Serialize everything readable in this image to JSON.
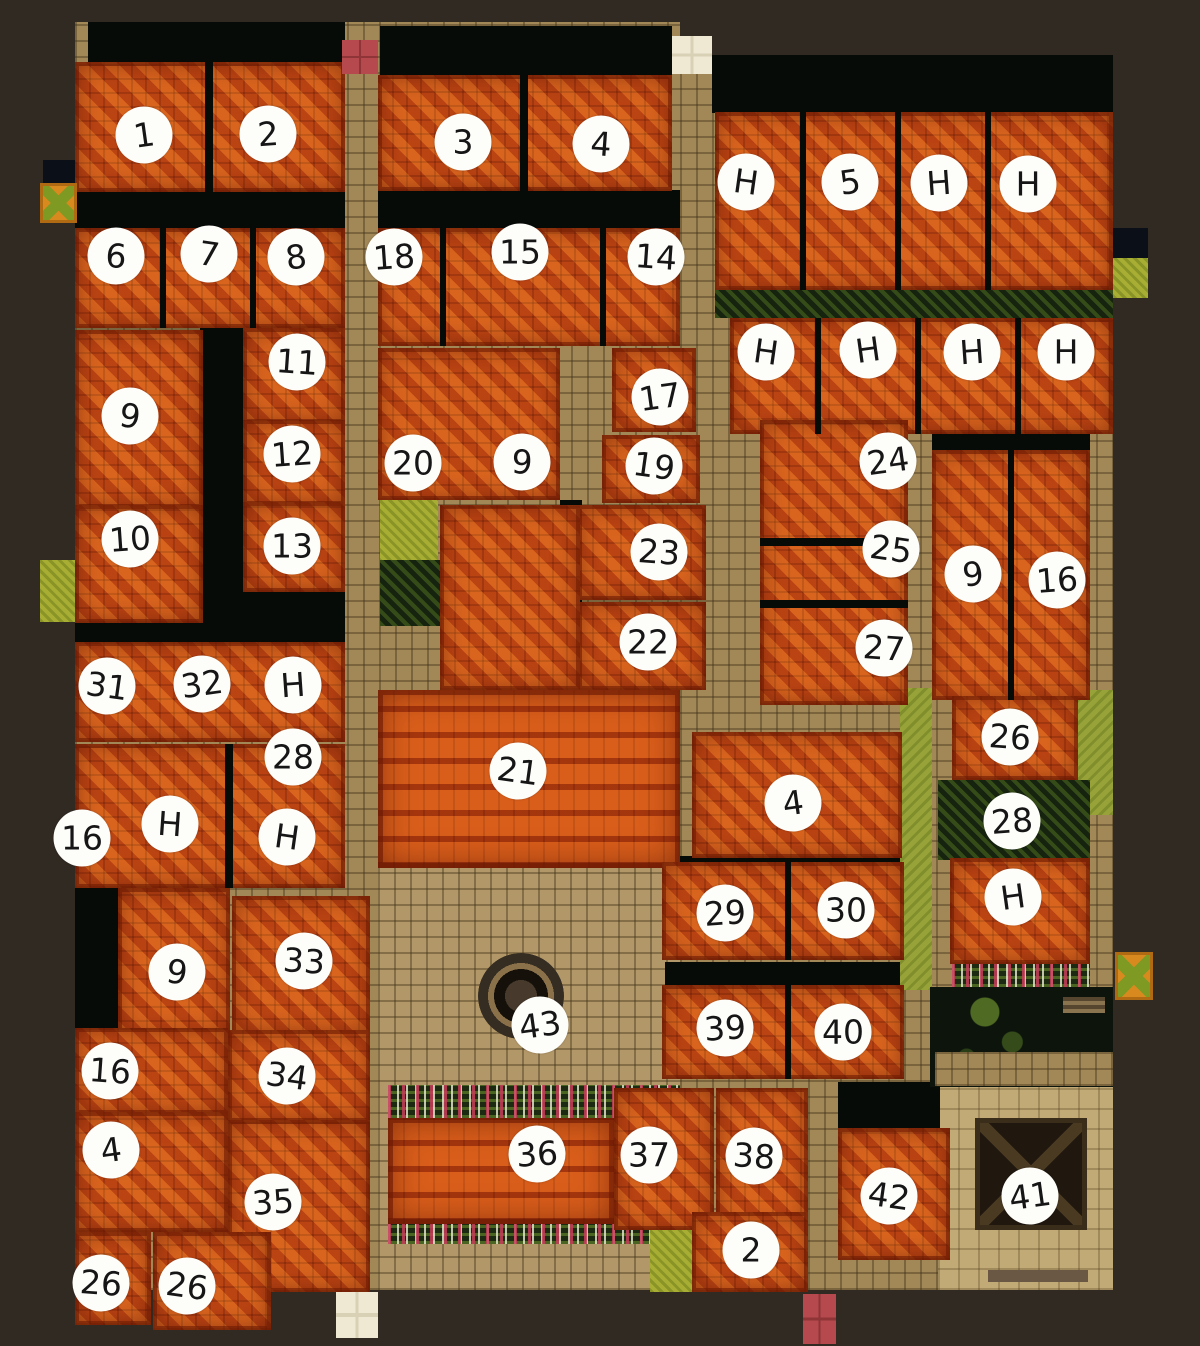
{
  "scene": {
    "description": "Top-down fantasy town battle map with orange tiled rooftops, stone streets, gardens and a central plaza with a well; buildings annotated with hand-drawn numbered circles",
    "marker_shape": "white circle",
    "marker_diameter_px": 57
  },
  "palette": {
    "background": "#312a22",
    "roof": "#c94e17",
    "roof_light": "#e8822c",
    "roof_dark": "#7a2408",
    "street": "#a28757",
    "plaza": "#b29768",
    "courtyard": "#c2aa76",
    "shadow": "#070b08",
    "hedge": "#16240f",
    "grass": "#a8ae33",
    "lawn": "#97a238",
    "dark_garden": "#0c140c",
    "marker_fill": "#fdfdfa",
    "marker_text": "#161616",
    "accent_red": "#b5494d",
    "accent_white": "#efe8d2"
  },
  "map": {
    "markers": [
      {
        "label": "1",
        "x": 144,
        "y": 135
      },
      {
        "label": "2",
        "x": 268,
        "y": 134
      },
      {
        "label": "3",
        "x": 463,
        "y": 142
      },
      {
        "label": "4",
        "x": 601,
        "y": 144
      },
      {
        "label": "H",
        "x": 746,
        "y": 182
      },
      {
        "label": "5",
        "x": 850,
        "y": 182
      },
      {
        "label": "H",
        "x": 939,
        "y": 183
      },
      {
        "label": "H",
        "x": 1028,
        "y": 184
      },
      {
        "label": "6",
        "x": 116,
        "y": 256
      },
      {
        "label": "7",
        "x": 209,
        "y": 254
      },
      {
        "label": "8",
        "x": 296,
        "y": 257
      },
      {
        "label": "18",
        "x": 394,
        "y": 257
      },
      {
        "label": "15",
        "x": 520,
        "y": 252
      },
      {
        "label": "14",
        "x": 656,
        "y": 257
      },
      {
        "label": "H",
        "x": 766,
        "y": 352
      },
      {
        "label": "H",
        "x": 868,
        "y": 350
      },
      {
        "label": "H",
        "x": 972,
        "y": 352
      },
      {
        "label": "H",
        "x": 1066,
        "y": 352
      },
      {
        "label": "11",
        "x": 297,
        "y": 362
      },
      {
        "label": "9",
        "x": 130,
        "y": 416
      },
      {
        "label": "17",
        "x": 660,
        "y": 397
      },
      {
        "label": "12",
        "x": 292,
        "y": 454
      },
      {
        "label": "20",
        "x": 413,
        "y": 463
      },
      {
        "label": "9",
        "x": 522,
        "y": 462
      },
      {
        "label": "19",
        "x": 654,
        "y": 466
      },
      {
        "label": "24",
        "x": 888,
        "y": 461
      },
      {
        "label": "10",
        "x": 130,
        "y": 539
      },
      {
        "label": "13",
        "x": 292,
        "y": 546
      },
      {
        "label": "23",
        "x": 659,
        "y": 552
      },
      {
        "label": "25",
        "x": 891,
        "y": 549
      },
      {
        "label": "9",
        "x": 973,
        "y": 574
      },
      {
        "label": "16",
        "x": 1057,
        "y": 580
      },
      {
        "label": "22",
        "x": 648,
        "y": 642
      },
      {
        "label": "27",
        "x": 884,
        "y": 648
      },
      {
        "label": "31",
        "x": 107,
        "y": 686
      },
      {
        "label": "32",
        "x": 202,
        "y": 684
      },
      {
        "label": "H",
        "x": 293,
        "y": 685
      },
      {
        "label": "28",
        "x": 293,
        "y": 757
      },
      {
        "label": "26",
        "x": 1010,
        "y": 737
      },
      {
        "label": "21",
        "x": 518,
        "y": 771
      },
      {
        "label": "4",
        "x": 793,
        "y": 803
      },
      {
        "label": "28",
        "x": 1012,
        "y": 821
      },
      {
        "label": "16",
        "x": 82,
        "y": 838
      },
      {
        "label": "H",
        "x": 170,
        "y": 824
      },
      {
        "label": "H",
        "x": 287,
        "y": 837
      },
      {
        "label": "H",
        "x": 1013,
        "y": 897
      },
      {
        "label": "29",
        "x": 725,
        "y": 913
      },
      {
        "label": "30",
        "x": 846,
        "y": 910
      },
      {
        "label": "33",
        "x": 304,
        "y": 961
      },
      {
        "label": "9",
        "x": 177,
        "y": 972
      },
      {
        "label": "43",
        "x": 540,
        "y": 1025
      },
      {
        "label": "39",
        "x": 725,
        "y": 1028
      },
      {
        "label": "40",
        "x": 843,
        "y": 1032
      },
      {
        "label": "16",
        "x": 110,
        "y": 1071
      },
      {
        "label": "34",
        "x": 287,
        "y": 1076
      },
      {
        "label": "4",
        "x": 111,
        "y": 1150
      },
      {
        "label": "36",
        "x": 537,
        "y": 1154
      },
      {
        "label": "37",
        "x": 649,
        "y": 1155
      },
      {
        "label": "38",
        "x": 754,
        "y": 1156
      },
      {
        "label": "42",
        "x": 889,
        "y": 1196
      },
      {
        "label": "41",
        "x": 1030,
        "y": 1196
      },
      {
        "label": "35",
        "x": 273,
        "y": 1202
      },
      {
        "label": "2",
        "x": 751,
        "y": 1250
      },
      {
        "label": "26",
        "x": 101,
        "y": 1283
      },
      {
        "label": "26",
        "x": 187,
        "y": 1286
      }
    ]
  }
}
